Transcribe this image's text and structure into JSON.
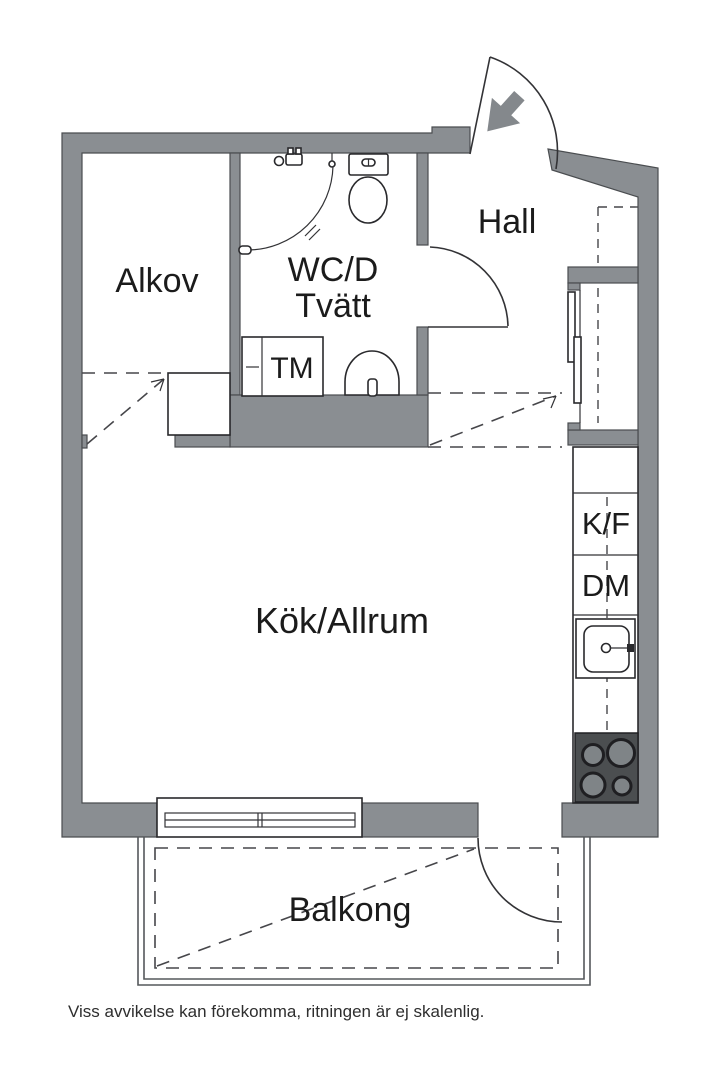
{
  "floorplan": {
    "rooms": {
      "alkov": {
        "label": "Alkov"
      },
      "wc_line1": {
        "label": "WC/D"
      },
      "wc_line2": {
        "label": "Tvätt"
      },
      "hall": {
        "label": "Hall"
      },
      "kitchen": {
        "label": "Kök/Allrum"
      },
      "balcony": {
        "label": "Balkong"
      }
    },
    "appliances": {
      "tm": {
        "label": "TM"
      },
      "kf": {
        "label": "K/F"
      },
      "dm": {
        "label": "DM"
      }
    },
    "disclaimer": {
      "text": "Viss avvikelse kan förekomma, ritningen är ej skalenlig."
    },
    "colors": {
      "wall": "#8a8e92",
      "outline": "#333336",
      "dashed": "#46464a",
      "stove_body": "#4b4e50",
      "burner": "#7f8487",
      "text": "#1b1b1b"
    },
    "icons": [
      "entrance-arrow-icon",
      "entrance-door-arc",
      "wc-door-arc",
      "balcony-door-arc",
      "toilet-icon",
      "shower-mixer-icon",
      "shower-curtain-icon",
      "wc-sink-icon",
      "washing-machine-icon",
      "kitchen-sink-icon",
      "stove-icon",
      "window-symbol",
      "balcony-railing",
      "wardrobe-cabinet",
      "closet-sliding-doors"
    ]
  }
}
